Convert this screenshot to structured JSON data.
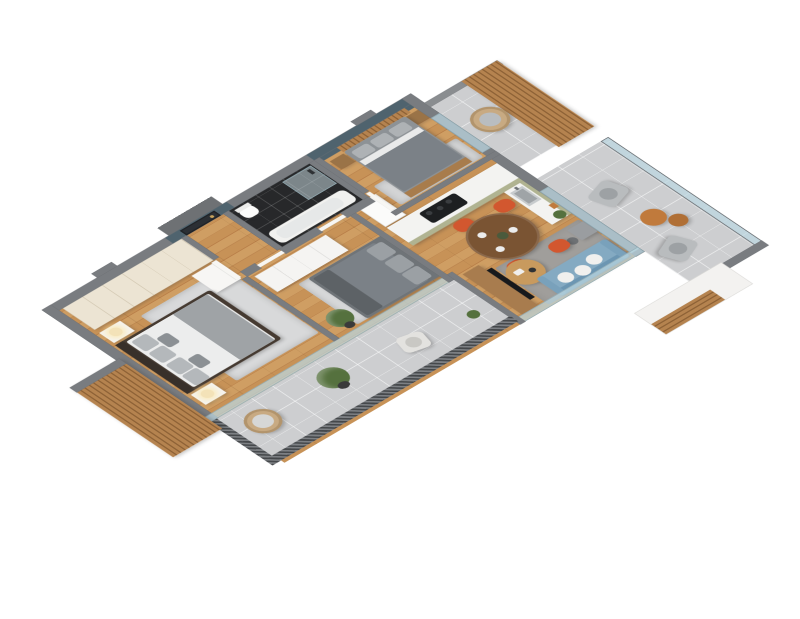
{
  "scene": {
    "view": "isometric-3d-apartment-floor-plan",
    "rooms": [
      {
        "name": "entrance-hall",
        "items": [
          "entrance-door",
          "teal-accent-wall"
        ]
      },
      {
        "name": "master-bedroom",
        "items": [
          "cream-wardrobe",
          "double-bed",
          "nightstand-lamp-left",
          "nightstand-lamp-right",
          "dresser",
          "area-rug"
        ]
      },
      {
        "name": "second-bedroom",
        "items": [
          "white-wardrobe",
          "double-bed-gray",
          "area-rug",
          "potted-plant"
        ]
      },
      {
        "name": "bathroom",
        "items": [
          "marble-wall",
          "shower-cabin",
          "toilet",
          "bathtub",
          "black-tile-floor"
        ]
      },
      {
        "name": "third-bedroom",
        "items": [
          "wood-slat-headboard",
          "double-bed-gray",
          "nightstand-left",
          "nightstand-right",
          "area-rug"
        ]
      },
      {
        "name": "kitchen",
        "items": [
          "fridge",
          "sage-counter",
          "cooktop",
          "sink",
          "shelf-decor"
        ]
      },
      {
        "name": "living-dining",
        "items": [
          "round-dining-table",
          "orange-chair-1",
          "orange-chair-2",
          "orange-chair-3",
          "orange-chair-4",
          "tv-console",
          "tv",
          "blue-sofa",
          "coffee-table",
          "gray-rug"
        ]
      },
      {
        "name": "southwest-balcony",
        "items": [
          "mesh-railing",
          "hanging-chair",
          "potted-plant",
          "lounge-armchair",
          "wood-slat-column"
        ]
      },
      {
        "name": "southeast-balcony",
        "items": [
          "armchair-1",
          "armchair-2",
          "side-table-large",
          "side-table-small",
          "railing"
        ]
      },
      {
        "name": "northeast-balcony",
        "items": [
          "wood-slat-screen",
          "hanging-chair"
        ]
      }
    ]
  },
  "palette": {
    "wall_top": "#797c80",
    "wall_white": "#f2f1ee",
    "teal": "#4f636e",
    "wood_floor": "#c79257",
    "wood_slats": "#a97c4a",
    "wardrobe_cream": "#ece4d3",
    "wardrobe_white": "#f5f4f2",
    "marble": "#d4d4d6",
    "bath_tile": "#27282a",
    "tub_white": "#f1f1ef",
    "bed_frame_dark": "#453a31",
    "duvet_white": "#eceded",
    "throw_gray": "#9fa3a6",
    "pillow_gray": "#b4b8bb",
    "bed_gray": "#7b8187",
    "kitchen_sage": "#b0b391",
    "counter_white": "#f3f3f1",
    "cooktop_black": "#1d1f21",
    "fridge_white": "#fbfbfa",
    "dining_wood": "#7a5433",
    "chair_orange": "#d2572f",
    "sofa_blue": "#84aac2",
    "sofa_blue_dark": "#6c96b2",
    "rug_living": "#a09e9b",
    "rug_light": "#d8d9da",
    "coffee_wood": "#c89a5e",
    "console_wood": "#a87c4e",
    "tv_black": "#17191c",
    "balcony_tile": "#cdced0",
    "mesh_dark": "#45484b",
    "glass": "#bcd8e2",
    "rattan": "#c8aa82",
    "plant_green": "#55713e",
    "pot_dark": "#3a3a3a",
    "door_dark": "#2b2f34",
    "side_table_orange": "#c07a3c",
    "armchair_gray": "#b9bcbe",
    "lamp_warm": "#f3e2b8"
  }
}
